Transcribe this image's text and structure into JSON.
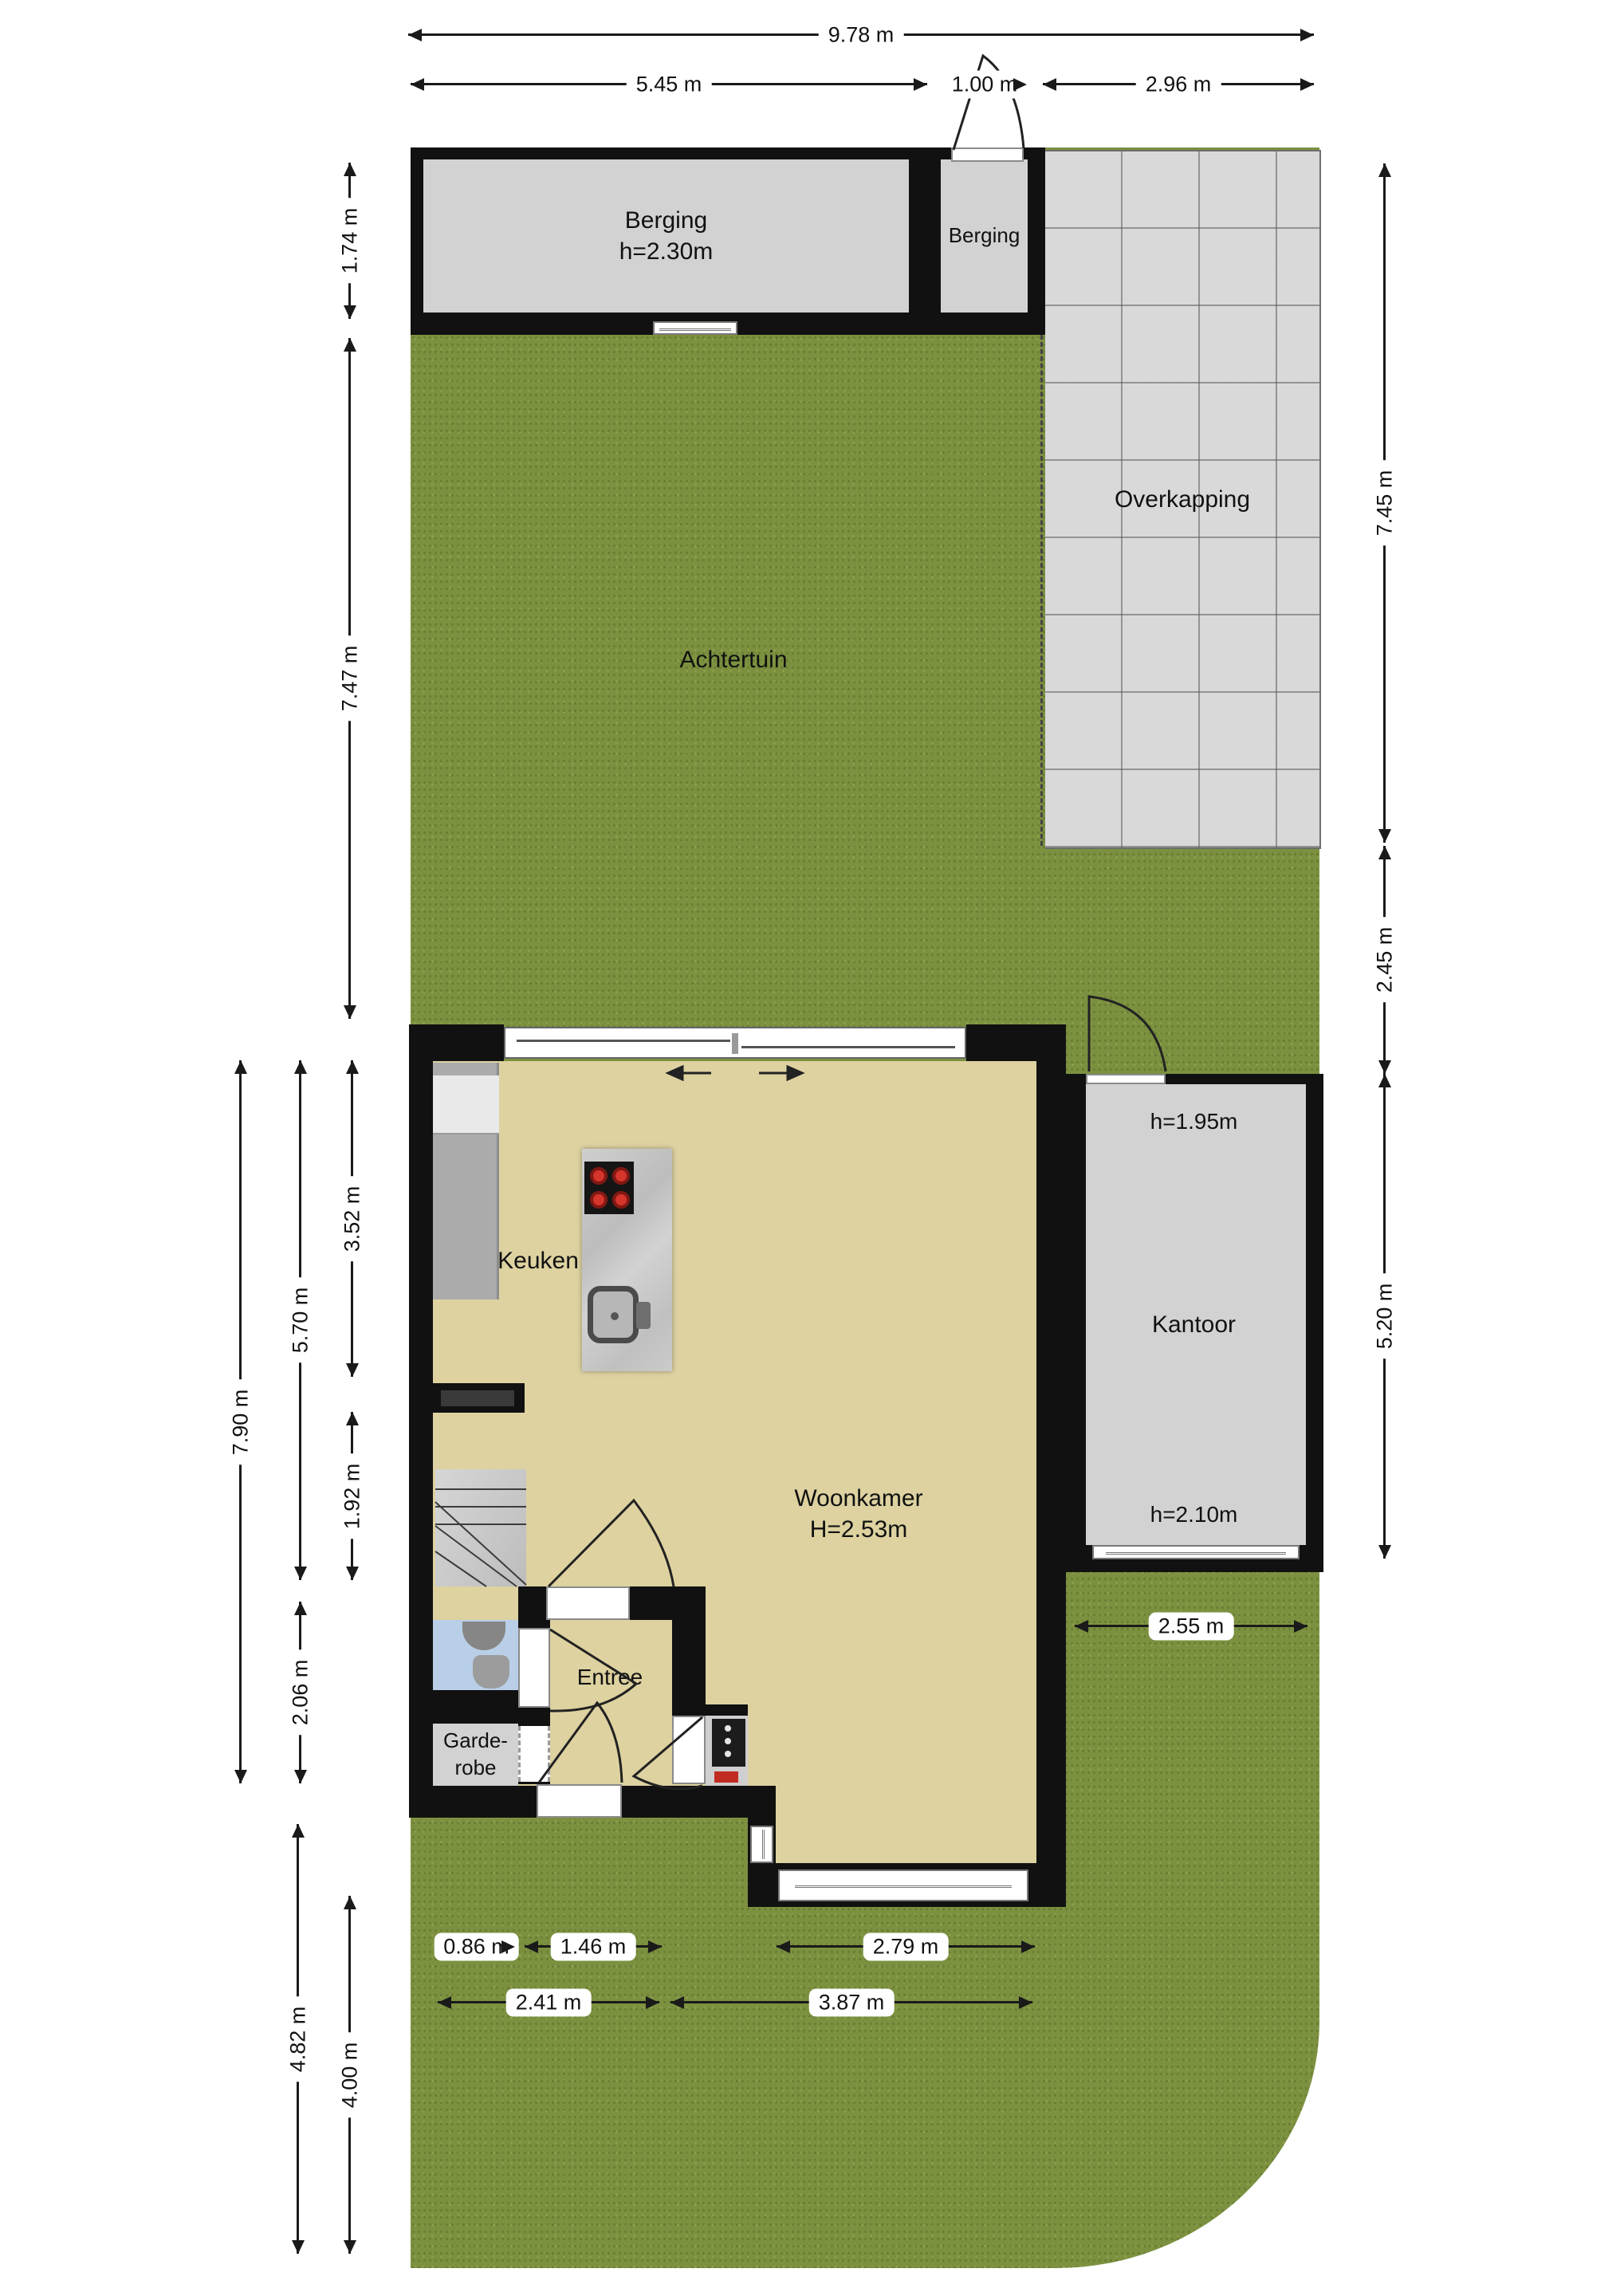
{
  "plan_type": "floorplan",
  "colors": {
    "grass": "#7c913f",
    "tile": "#d9d9d9",
    "wall": "#111111",
    "floor": "#ddd2a0",
    "wet_room": "#b9cfe8",
    "counter": "#ababab",
    "burner": "#d5352b",
    "dimension_line": "#1a1a1a"
  },
  "rooms": {
    "achtertuin": "Achtertuin",
    "overkapping": "Overkapping",
    "berging_large_name": "Berging",
    "berging_large_height": "h=2.30m",
    "berging_small": "Berging",
    "keuken": "Keuken",
    "woonkamer_name": "Woonkamer",
    "woonkamer_height": "H=2.53m",
    "entree": "Entree",
    "garderobe_line1": "Garde-",
    "garderobe_line2": "robe",
    "kantoor": "Kantoor",
    "kantoor_height_top": "h=1.95m",
    "kantoor_height_bottom": "h=2.10m"
  },
  "dimensions": {
    "top_total": "9.78 m",
    "top_left": "5.45 m",
    "top_mid": "1.00 m",
    "top_right": "2.96 m",
    "left_berging": "1.74 m",
    "left_achtertuin": "7.47 m",
    "left_house_total": "7.90 m",
    "left_house_upper": "5.70 m",
    "left_keuken": "3.52 m",
    "left_mid": "1.92 m",
    "left_entree": "2.06 m",
    "left_front_total": "4.82 m",
    "left_front": "4.00 m",
    "right_overkapping": "7.45 m",
    "right_gap": "2.45 m",
    "right_kantoor": "5.20 m",
    "bottom_row1": [
      "0.86 m",
      "1.46 m",
      "2.79 m"
    ],
    "bottom_row2": [
      "2.41 m",
      "3.87 m"
    ],
    "kantoor_width": "2.55 m"
  }
}
